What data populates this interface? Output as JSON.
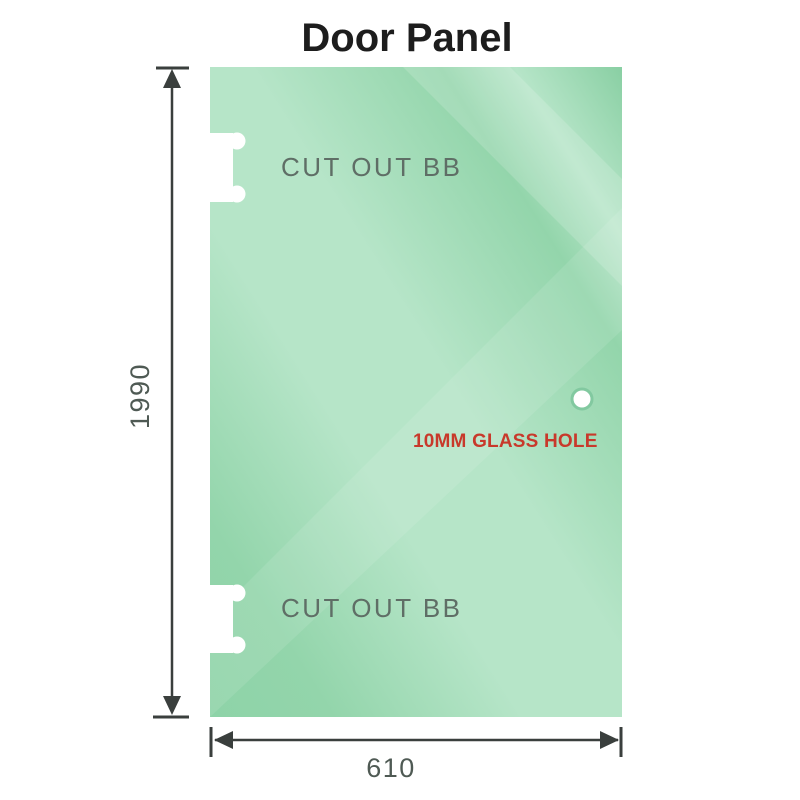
{
  "title": "Door Panel",
  "panel": {
    "cutout_top_label": "CUT OUT BB",
    "cutout_bottom_label": "CUT OUT BB",
    "hole_label": "10MM GLASS HOLE"
  },
  "dimensions": {
    "height_label": "1990",
    "width_label": "610"
  },
  "colors": {
    "glass_dark": "#89cfa3",
    "glass_mid": "#93d5ab",
    "glass_light": "#b6e5c8",
    "glass_edge": "#8ed3a8",
    "hole_ring": "#82c9a0",
    "hole_fill": "#ffffff",
    "cutout_fill": "#ffffff",
    "hole_label_red": "#c8392b",
    "cutout_label_gray": "#5f6e66",
    "dimension_gray": "#3a3f3d",
    "dimension_text_gray": "#4f5a54",
    "title_black": "#1d1d1d"
  }
}
